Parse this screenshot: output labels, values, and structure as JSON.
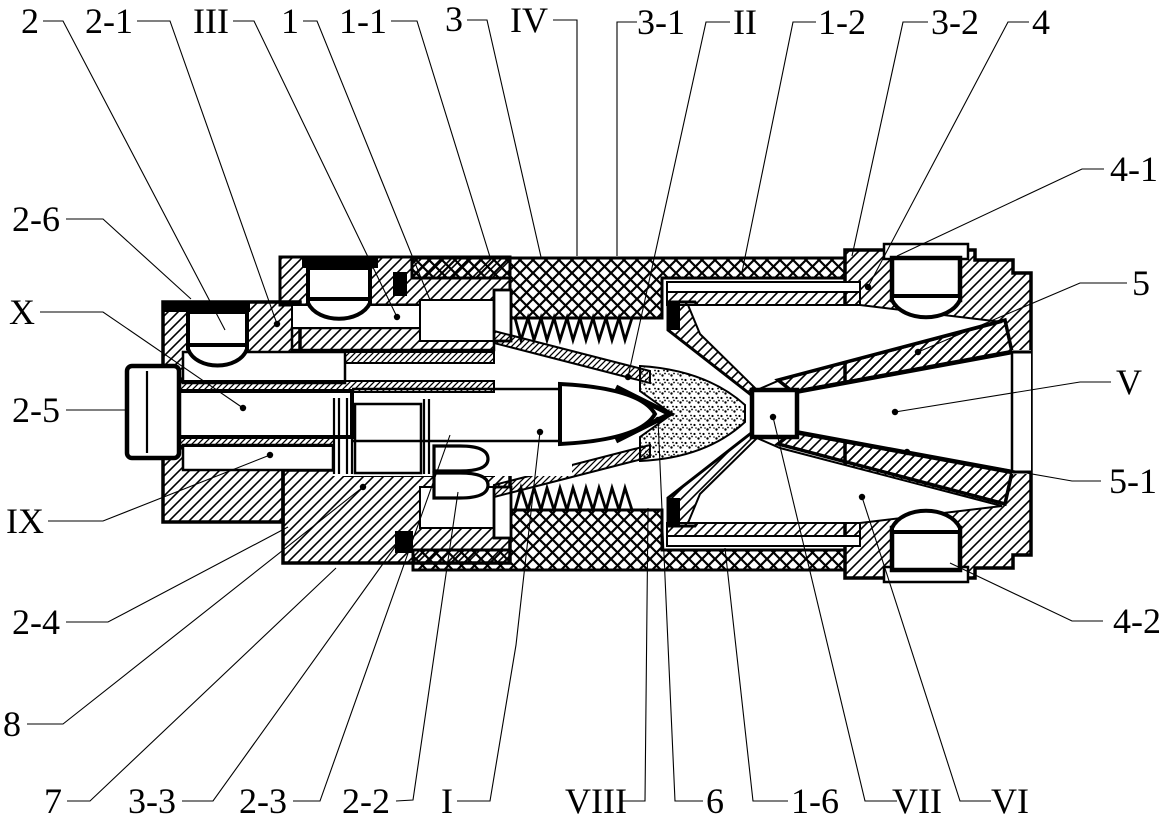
{
  "figure": {
    "background": "#ffffff",
    "line_color": "#000000",
    "type": "patent-cross-section-drawing"
  },
  "callouts": [
    {
      "label": "2",
      "x": 30,
      "y": 21,
      "leader": [
        [
          43,
          21
        ],
        [
          63,
          21
        ],
        [
          225,
          330
        ]
      ],
      "dot": false
    },
    {
      "label": "2-1",
      "x": 109,
      "y": 21,
      "leader": [
        [
          137,
          21
        ],
        [
          170,
          21
        ],
        [
          277,
          324
        ]
      ],
      "dot": true
    },
    {
      "label": "III",
      "x": 211,
      "y": 21,
      "leader": [
        [
          233,
          21
        ],
        [
          254,
          21
        ],
        [
          397,
          317
        ]
      ],
      "dot": true
    },
    {
      "label": "1",
      "x": 290,
      "y": 21,
      "leader": [
        [
          303,
          21
        ],
        [
          317,
          21
        ],
        [
          430,
          300
        ]
      ],
      "dot": false
    },
    {
      "label": "1-1",
      "x": 363,
      "y": 21,
      "leader": [
        [
          391,
          21
        ],
        [
          417,
          21
        ],
        [
          490,
          257
        ]
      ],
      "dot": false
    },
    {
      "label": "3",
      "x": 454,
      "y": 19,
      "leader": [
        [
          467,
          20
        ],
        [
          487,
          20
        ],
        [
          541,
          257
        ]
      ],
      "dot": false
    },
    {
      "label": "IV",
      "x": 529,
      "y": 20,
      "leader": [
        [
          553,
          20
        ],
        [
          577,
          20
        ],
        [
          577,
          256
        ]
      ],
      "dot": false
    },
    {
      "label": "3-1",
      "x": 661,
      "y": 22,
      "leader": [
        [
          637,
          22
        ],
        [
          617,
          22
        ],
        [
          617,
          256
        ]
      ],
      "dot": false
    },
    {
      "label": "II",
      "x": 745,
      "y": 22,
      "leader": [
        [
          730,
          22
        ],
        [
          706,
          22
        ],
        [
          628,
          377
        ]
      ],
      "dot": true
    },
    {
      "label": "1-2",
      "x": 842,
      "y": 22,
      "leader": [
        [
          816,
          22
        ],
        [
          793,
          22
        ],
        [
          742,
          272
        ]
      ],
      "dot": false
    },
    {
      "label": "3-2",
      "x": 955,
      "y": 22,
      "leader": [
        [
          928,
          22
        ],
        [
          903,
          22
        ],
        [
          852,
          256
        ]
      ],
      "dot": false
    },
    {
      "label": "4",
      "x": 1041,
      "y": 22,
      "leader": [
        [
          1029,
          22
        ],
        [
          1008,
          22
        ],
        [
          868,
          287
        ]
      ],
      "dot": true
    },
    {
      "label": "4-1",
      "x": 1134,
      "y": 169,
      "leader": [
        [
          1104,
          169
        ],
        [
          1082,
          169
        ],
        [
          897,
          256
        ]
      ],
      "dot": false
    },
    {
      "label": "5",
      "x": 1141,
      "y": 283,
      "leader": [
        [
          1127,
          283
        ],
        [
          1080,
          283
        ],
        [
          918,
          352
        ]
      ],
      "dot": true
    },
    {
      "label": "V",
      "x": 1129,
      "y": 382,
      "leader": [
        [
          1111,
          382
        ],
        [
          1080,
          382
        ],
        [
          895,
          412
        ]
      ],
      "dot": true
    },
    {
      "label": "5-1",
      "x": 1133,
      "y": 481,
      "leader": [
        [
          1101,
          481
        ],
        [
          1072,
          481
        ],
        [
          907,
          452
        ]
      ],
      "dot": true
    },
    {
      "label": "4-2",
      "x": 1137,
      "y": 621,
      "leader": [
        [
          1103,
          621
        ],
        [
          1072,
          621
        ],
        [
          950,
          563
        ]
      ],
      "dot": false
    },
    {
      "label": "2-6",
      "x": 36,
      "y": 219,
      "leader": [
        [
          66,
          219
        ],
        [
          103,
          219
        ],
        [
          191,
          299
        ]
      ],
      "dot": false
    },
    {
      "label": "X",
      "x": 22,
      "y": 312,
      "leader": [
        [
          40,
          312
        ],
        [
          103,
          312
        ],
        [
          243,
          408
        ]
      ],
      "dot": true
    },
    {
      "label": "2-5",
      "x": 36,
      "y": 410,
      "leader": [
        [
          66,
          410
        ],
        [
          128,
          410
        ]
      ],
      "dot": false
    },
    {
      "label": "IX",
      "x": 25,
      "y": 521,
      "leader": [
        [
          48,
          521
        ],
        [
          103,
          521
        ],
        [
          270,
          455
        ]
      ],
      "dot": true
    },
    {
      "label": "2-4",
      "x": 36,
      "y": 622,
      "leader": [
        [
          66,
          622
        ],
        [
          108,
          622
        ],
        [
          288,
          527
        ]
      ],
      "dot": false
    },
    {
      "label": "8",
      "x": 12,
      "y": 724,
      "leader": [
        [
          27,
          724
        ],
        [
          63,
          724
        ],
        [
          363,
          487
        ]
      ],
      "dot": true
    },
    {
      "label": "7",
      "x": 53,
      "y": 801,
      "leader": [
        [
          67,
          801
        ],
        [
          90,
          801
        ],
        [
          336,
          568
        ]
      ],
      "dot": false
    },
    {
      "label": "3-3",
      "x": 152,
      "y": 801,
      "leader": [
        [
          182,
          801
        ],
        [
          213,
          801
        ],
        [
          400,
          540
        ]
      ],
      "dot": false
    },
    {
      "label": "2-3",
      "x": 263,
      "y": 801,
      "leader": [
        [
          293,
          801
        ],
        [
          320,
          801
        ],
        [
          450,
          435
        ]
      ],
      "dot": false
    },
    {
      "label": "2-2",
      "x": 366,
      "y": 801,
      "leader": [
        [
          396,
          801
        ],
        [
          413,
          800
        ],
        [
          458,
          492
        ]
      ],
      "dot": false
    },
    {
      "label": "I",
      "x": 447,
      "y": 801,
      "leader": [
        [
          457,
          801
        ],
        [
          490,
          801
        ],
        [
          516,
          645
        ],
        [
          540,
          432
        ]
      ],
      "dot": true
    },
    {
      "label": "VIII",
      "x": 596,
      "y": 801,
      "leader": [
        [
          621,
          801
        ],
        [
          645,
          801
        ],
        [
          648,
          508
        ]
      ],
      "dot": false
    },
    {
      "label": "6",
      "x": 715,
      "y": 801,
      "leader": [
        [
          703,
          801
        ],
        [
          675,
          801
        ],
        [
          658,
          420
        ]
      ],
      "dot": true
    },
    {
      "label": "1-6",
      "x": 815,
      "y": 801,
      "leader": [
        [
          788,
          801
        ],
        [
          753,
          801
        ],
        [
          725,
          548
        ]
      ],
      "dot": false
    },
    {
      "label": "VII",
      "x": 917,
      "y": 801,
      "leader": [
        [
          897,
          801
        ],
        [
          865,
          801
        ],
        [
          773,
          417
        ]
      ],
      "dot": true
    },
    {
      "label": "VI",
      "x": 1010,
      "y": 801,
      "leader": [
        [
          991,
          801
        ],
        [
          960,
          801
        ],
        [
          862,
          497
        ]
      ],
      "dot": true
    }
  ]
}
